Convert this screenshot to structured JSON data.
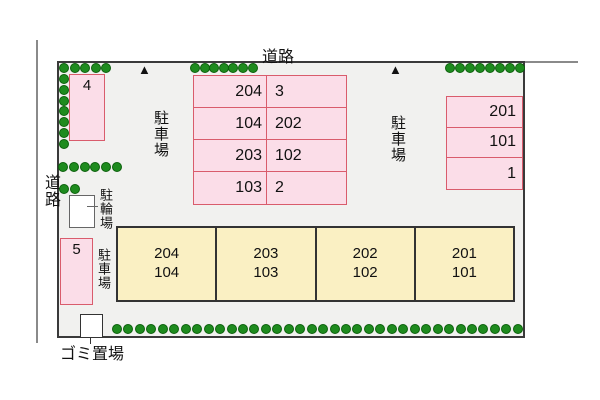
{
  "site": {
    "roads": {
      "top_label": "道路",
      "left_label": "道路"
    },
    "markers": {
      "triangle": "▲"
    },
    "areas": {
      "parking_label": "駐車場",
      "bicycle_label": "駐輪場",
      "garbage_label": "ゴミ置場"
    },
    "lots": {
      "box4": "4",
      "box5": "5",
      "central": {
        "rows": [
          [
            "204",
            "3"
          ],
          [
            "104",
            "202"
          ],
          [
            "203",
            "102"
          ],
          [
            "103",
            "2"
          ]
        ]
      },
      "right": {
        "rows": [
          "201",
          "101",
          "1"
        ]
      }
    },
    "building": {
      "units": [
        {
          "upper": "204",
          "lower": "104"
        },
        {
          "upper": "203",
          "lower": "103"
        },
        {
          "upper": "202",
          "lower": "102"
        },
        {
          "upper": "201",
          "lower": "101"
        }
      ]
    },
    "colors": {
      "site_background": "#f1f1ef",
      "site_border": "#3a3a3a",
      "road_line": "#8a8a8a",
      "lot_fill": "#fbdde8",
      "lot_border": "#d95c6c",
      "building_fill": "#faf0c3",
      "building_border": "#333333",
      "tree_fill": "#1e8b1e",
      "tree_border": "#0c600c"
    },
    "greenery": {
      "icon": "tree-icon",
      "groups": [
        {
          "x": 59,
          "y": 63,
          "count": 5,
          "spacing": 10.6,
          "dir": "h"
        },
        {
          "x": 59,
          "y": 74,
          "count": 7,
          "spacing": 10.8,
          "dir": "v"
        },
        {
          "x": 190,
          "y": 63,
          "count": 7,
          "spacing": 9.6,
          "dir": "h"
        },
        {
          "x": 445,
          "y": 63,
          "count": 8,
          "spacing": 10,
          "dir": "h"
        },
        {
          "x": 58,
          "y": 162,
          "count": 6,
          "spacing": 10.8,
          "dir": "h"
        },
        {
          "x": 59,
          "y": 184,
          "count": 2,
          "spacing": 11,
          "dir": "h"
        },
        {
          "x": 112,
          "y": 324,
          "count": 36,
          "spacing": 11.45,
          "dir": "h"
        }
      ]
    }
  }
}
